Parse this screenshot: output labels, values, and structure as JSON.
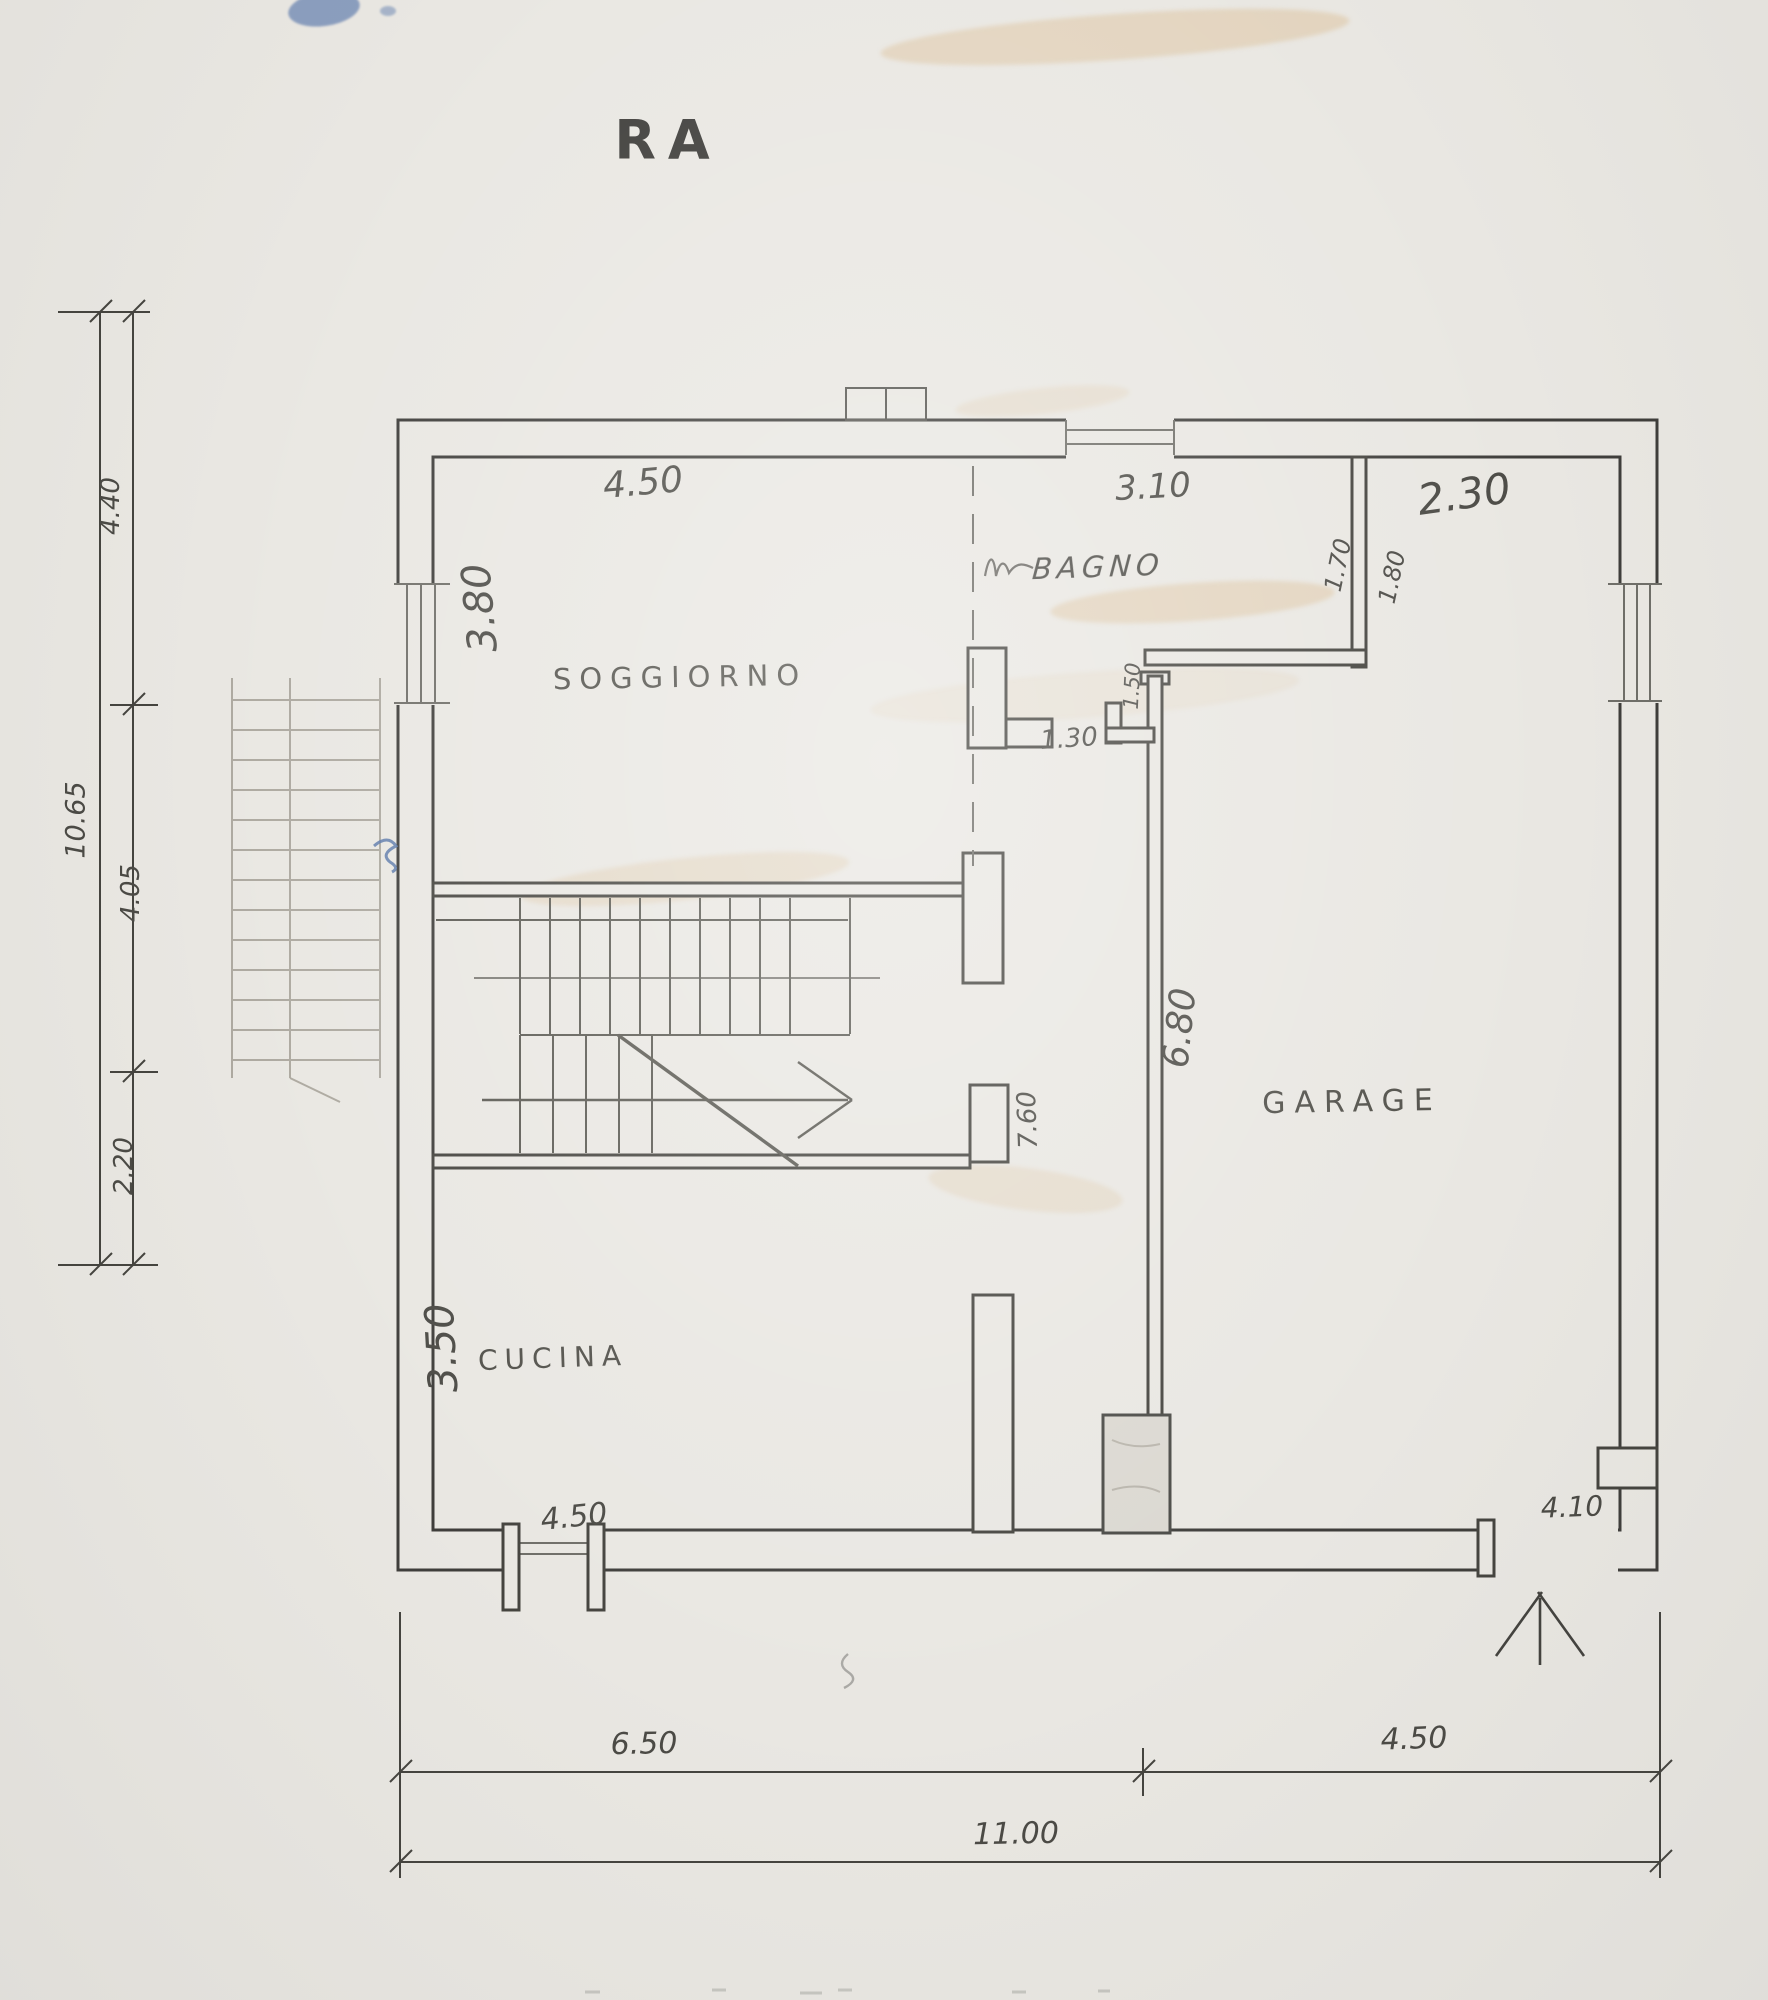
{
  "title": "RA",
  "rooms": {
    "soggiorno": "SOGGIORNO",
    "bagno": "BAGNO",
    "cucina": "CUCINA",
    "garage": "GARAGE"
  },
  "dims": {
    "top_soggiorno": "4.50",
    "top_bagno": "3.10",
    "top_right": "2.30",
    "soggiorno_height": "3.80",
    "bagno_width": "1.70",
    "right_room_width": "1.80",
    "bagno_door": "1.50",
    "hall_opening": "1.30",
    "hall_length": "7.60",
    "garage_length": "6.80",
    "cucina_height": "3.50",
    "cucina_window": "4.50",
    "garage_door": "4.10",
    "bottom_left": "6.50",
    "bottom_right": "4.50",
    "bottom_total": "11.00",
    "left_top": "4.40",
    "left_total": "10.65",
    "left_mid": "4.05",
    "left_bottom": "2.20"
  }
}
